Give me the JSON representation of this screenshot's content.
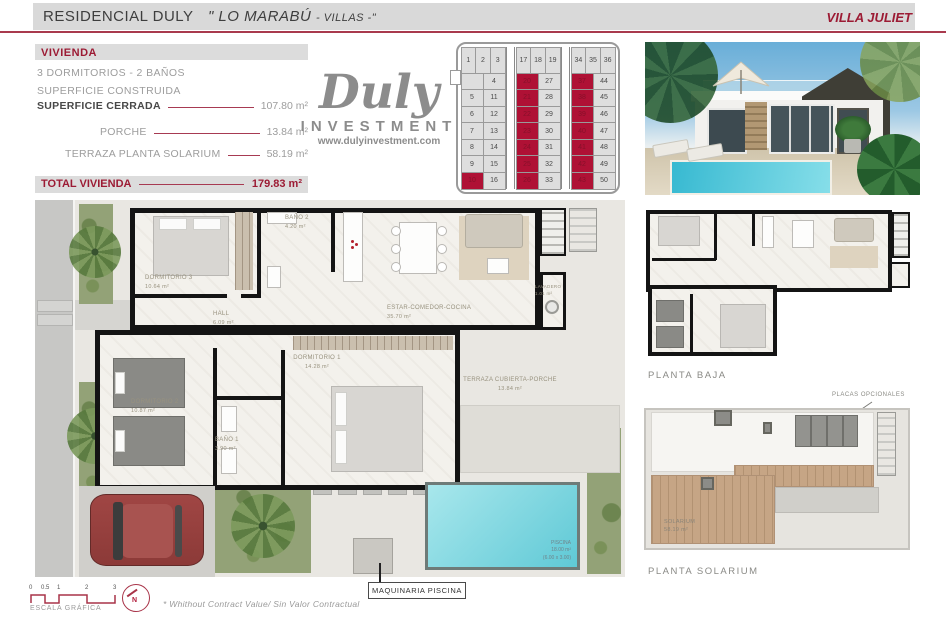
{
  "header": {
    "project": "RESIDENCIAL DULY",
    "name_part": "\" LO MARABÚ",
    "villas_part": "- VILLAS -\"",
    "villa": "VILLA JULIET"
  },
  "info": {
    "section_label": "VIVIENDA",
    "line1": "3 DORMITORIOS - 2 BAÑOS",
    "line2": "SUPERFICIE CONSTRUIDA",
    "rows": [
      {
        "label": "SUPERFICIE CERRADA",
        "value": "107.80 m²"
      },
      {
        "label": "PORCHE",
        "value": "13.84 m²"
      },
      {
        "label": "TERRAZA PLANTA SOLARIUM",
        "value": "58.19 m²"
      }
    ],
    "total_label": "TOTAL VIVIENDA",
    "total_value": "179.83 m²"
  },
  "logo": {
    "name": "Duly",
    "sub": "INVESTMENT",
    "url": "www.dulyinvestment.com"
  },
  "site_grid": {
    "groups": [
      {
        "top": [
          "1",
          "2",
          "3"
        ],
        "rows": [
          [
            "",
            "4"
          ],
          [
            "5",
            "11"
          ],
          [
            "6",
            "12"
          ],
          [
            "7",
            "13"
          ],
          [
            "8",
            "14"
          ],
          [
            "9",
            "15"
          ],
          [
            "10",
            "16"
          ]
        ],
        "red": [
          "10"
        ]
      },
      {
        "top": [
          "17",
          "18",
          "19"
        ],
        "rows": [
          [
            "20",
            "27"
          ],
          [
            "21",
            "28"
          ],
          [
            "22",
            "29"
          ],
          [
            "23",
            "30"
          ],
          [
            "24",
            "31"
          ],
          [
            "25",
            "32"
          ],
          [
            "26",
            "33"
          ]
        ],
        "red": [
          "20",
          "21",
          "22",
          "23",
          "24",
          "25",
          "26"
        ]
      },
      {
        "top": [
          "34",
          "35",
          "36"
        ],
        "rows": [
          [
            "37",
            "44"
          ],
          [
            "38",
            "45"
          ],
          [
            "39",
            "46"
          ],
          [
            "40",
            "47"
          ],
          [
            "41",
            "48"
          ],
          [
            "42",
            "49"
          ],
          [
            "43",
            "50"
          ]
        ],
        "red": [
          "37",
          "38",
          "39",
          "40",
          "41",
          "42",
          "43"
        ]
      }
    ]
  },
  "plan": {
    "rooms": {
      "dormitorio3": {
        "name": "DORMITORIO 3",
        "area": "10.64 m²"
      },
      "bano2": {
        "name": "BAÑO 2",
        "area": "4.20 m²"
      },
      "hall": {
        "name": "HALL",
        "area": "6.09 m²"
      },
      "estar": {
        "name": "ESTAR-COMEDOR-COCINA",
        "area": "35.70 m²"
      },
      "lavadero": {
        "name": "LAVADERO",
        "area": "1.01 m²"
      },
      "dormitorio1": {
        "name": "DORMITORIO 1",
        "area": "14.28 m²"
      },
      "dormitorio2": {
        "name": "DORMITORIO 2",
        "area": "10.87 m²"
      },
      "bano1": {
        "name": "BAÑO 1",
        "area": "3.90 m²"
      },
      "terraza": {
        "name": "TERRAZA CUBIERTA-PORCHE",
        "area": "13.84 m²"
      },
      "piscina": {
        "name": "PISCINA",
        "area": "18.00 m²",
        "dims": "(6.00 x 3.00)"
      }
    },
    "machinery_label": "MAQUINARIA PISCINA"
  },
  "planta_baja": {
    "label": "PLANTA BAJA"
  },
  "planta_solarium": {
    "label": "PLANTA SOLARIUM",
    "room": "SOLARIUM",
    "area": "58.19 m²",
    "annotation": "PLACAS OPCIONALES"
  },
  "footer": {
    "ticks": [
      "0",
      "0.5",
      "1",
      "2",
      "3"
    ],
    "scale_label": "ESCALA GRÁFICA",
    "note": "* Whithout Contract Value/ Sin Valor Contractual",
    "compass": "N"
  },
  "colors": {
    "accent": "#a81d3c",
    "red_cell": "#af1135",
    "gray_text": "#9c9c9c"
  }
}
